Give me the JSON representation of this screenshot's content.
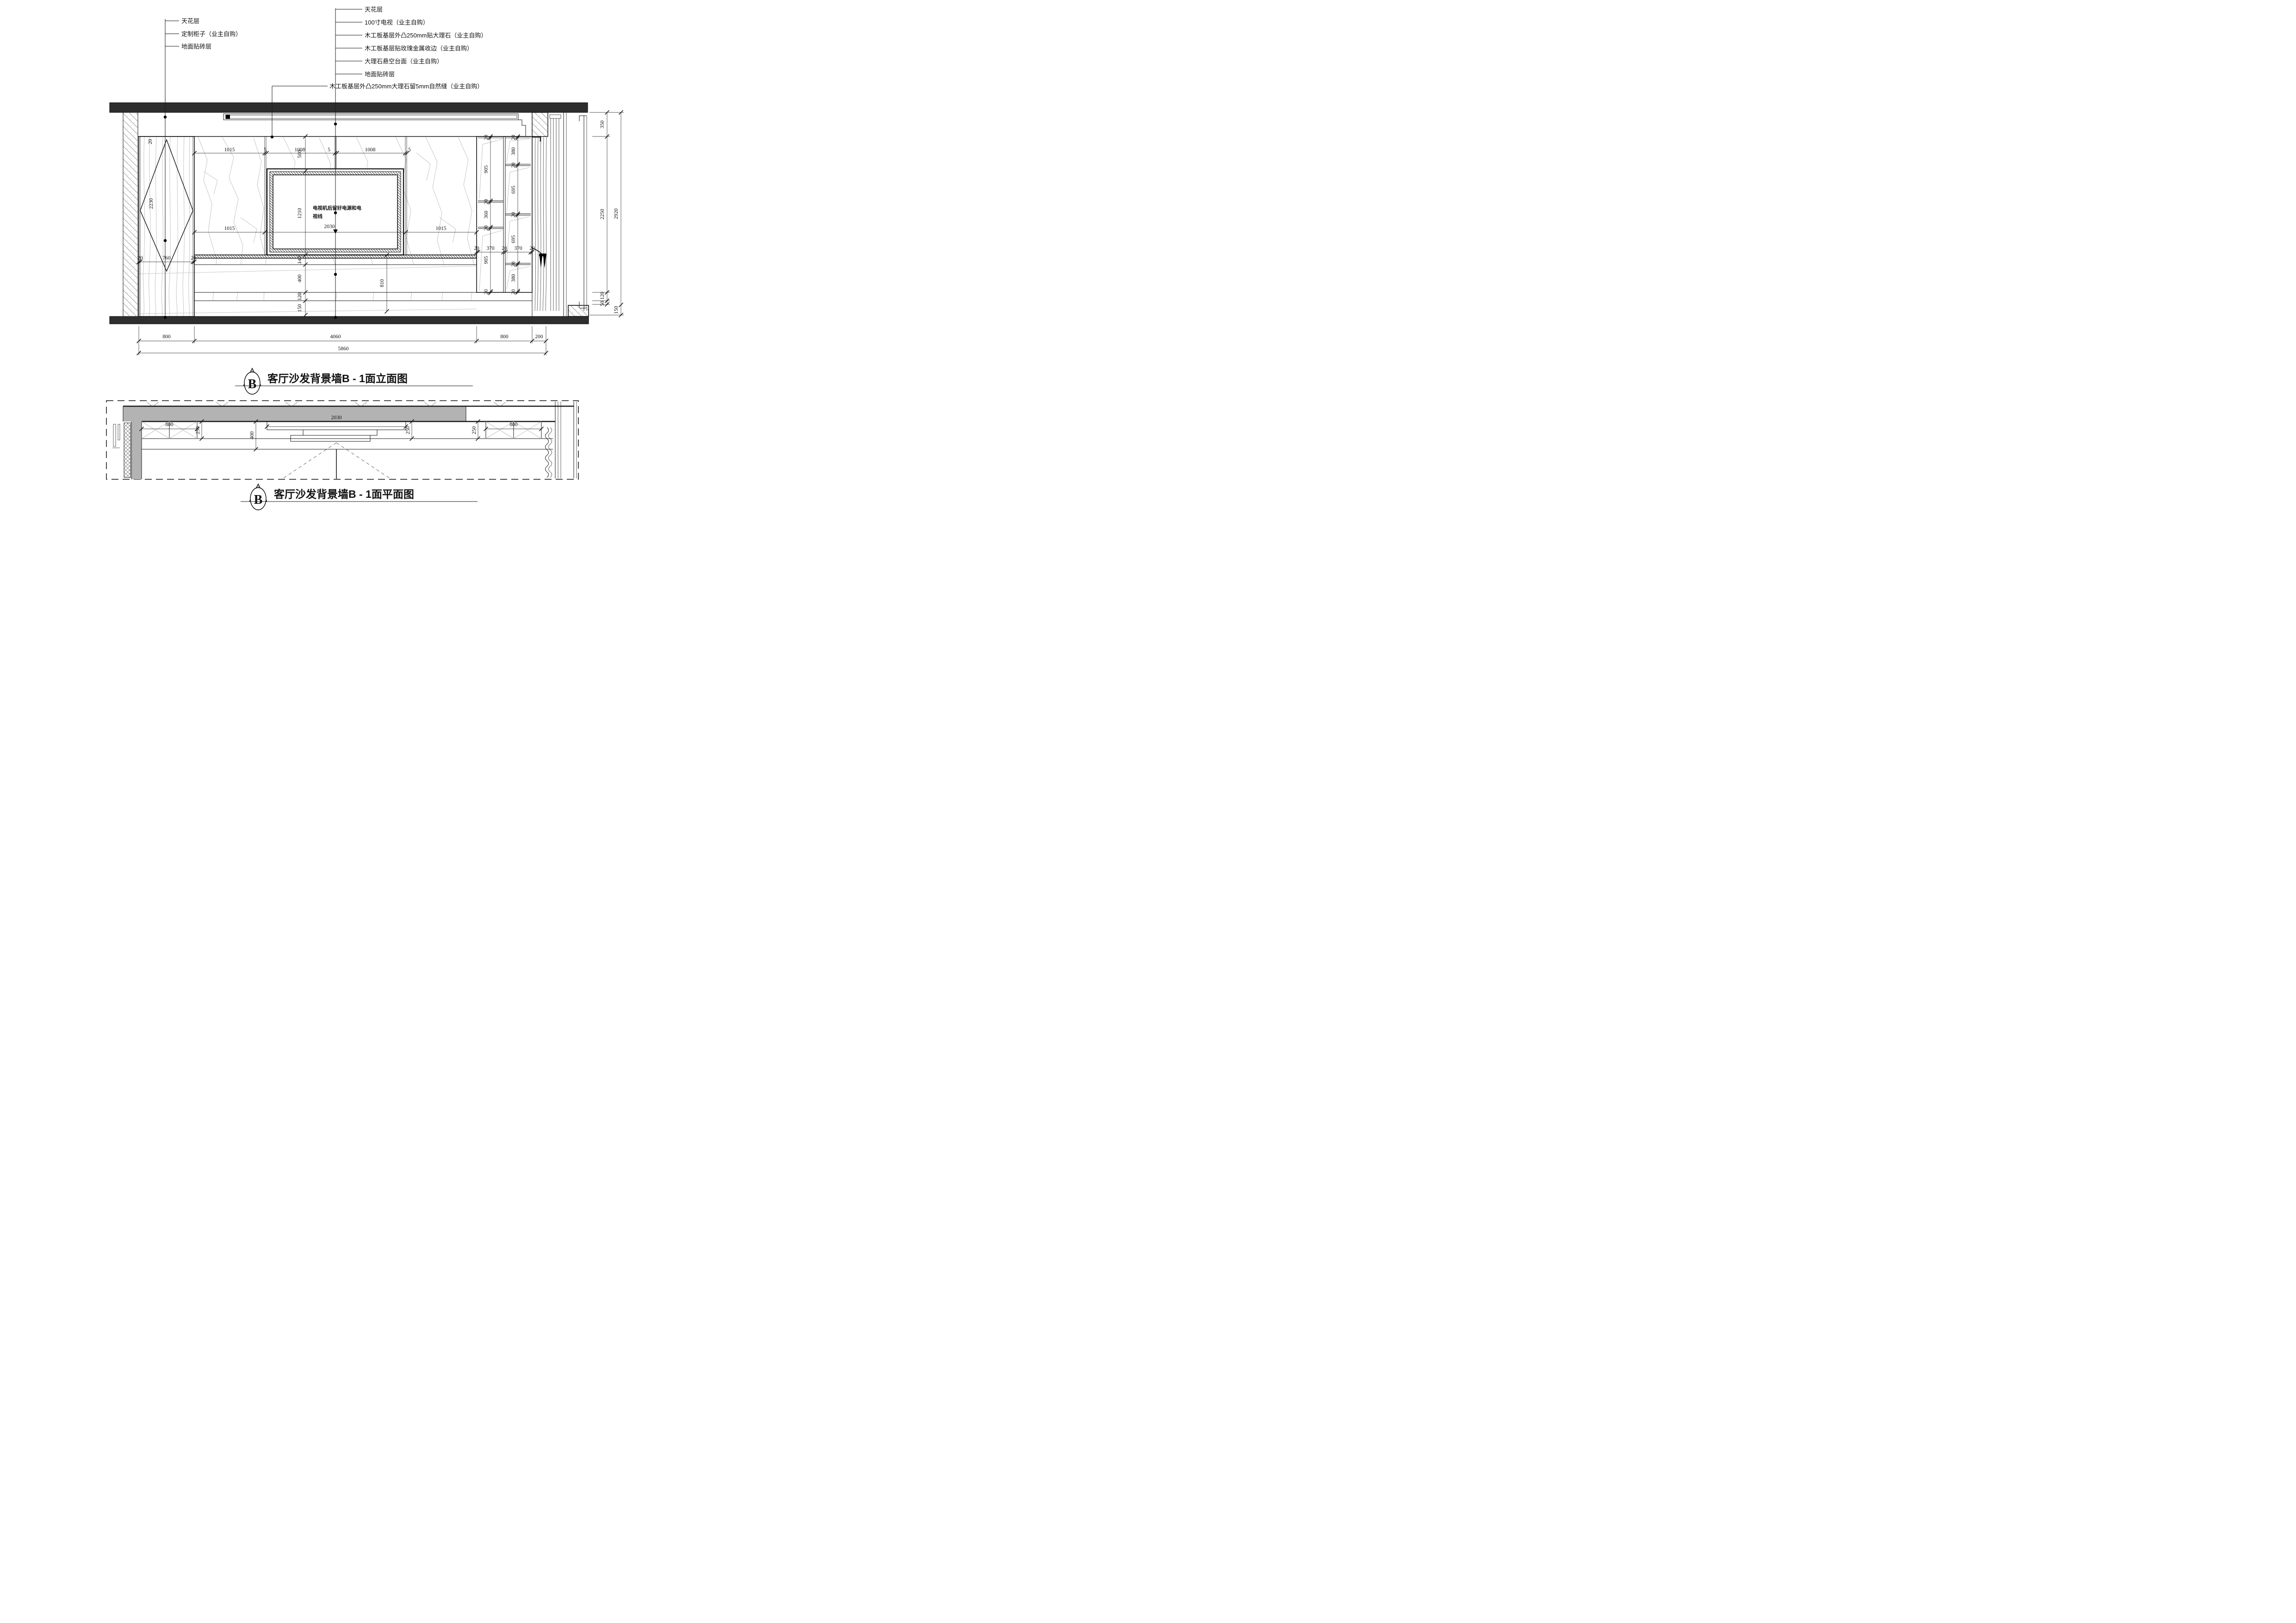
{
  "colors": {
    "beam_fill": "#2e2e2e",
    "wall_gray": "#b3b3b3"
  },
  "callouts_left": [
    "天花层",
    "定制柜子（业主自购）",
    "地面贴砖层"
  ],
  "callouts_middle": [
    "天花层",
    "100寸电视（业主自购）",
    "木工板基层外凸250mm贴大理石（业主自购）",
    "木工板基层贴玫瑰金属收边（业主自购）",
    "大理石悬空台面（业主自购）",
    "地面贴砖层"
  ],
  "callout_seam": "木工板基层外凸250mm大理石留5mm自然缝（业主自购）",
  "tv_note": {
    "line1": "电视机后留好电源和电",
    "line2": "视线"
  },
  "elevation": {
    "top_dims": [
      "1015",
      "5",
      "1008",
      "5",
      "1008",
      "5"
    ],
    "left_stack_dims": [
      "500",
      "1210",
      "140",
      "400",
      "120",
      "150"
    ],
    "mid_dims": [
      "1015",
      "2030",
      "1015"
    ],
    "tv_offset_dim": "810",
    "panel_width_dims": [
      "20",
      "760",
      "20"
    ],
    "panel_height_dim": "2230",
    "panel_frame_dim": "20",
    "cab_col1_dims": [
      "20",
      "905",
      "20",
      "360",
      "20",
      "905",
      "20"
    ],
    "cab_col2_dims": [
      "20",
      "380",
      "20",
      "695",
      "20",
      "695",
      "20",
      "380",
      "20"
    ],
    "cab_width_dims": [
      "20",
      "370",
      "20",
      "370",
      "20"
    ],
    "right_inner_dims": [
      "350",
      "2250",
      "120",
      "50"
    ],
    "right_outer_dims": [
      "2920",
      "150"
    ],
    "bottom_dims": [
      "800",
      "4060",
      "800",
      "200"
    ],
    "bottom_total_dim": "5860"
  },
  "plan": {
    "dims": [
      "800",
      "250",
      "400",
      "2030",
      "250",
      "250",
      "800"
    ]
  },
  "titles": {
    "elevation": "客厅沙发背景墙B - 1面立面图",
    "plan": "客厅沙发背景墙B - 1面平面图",
    "marker_letter": "B"
  }
}
